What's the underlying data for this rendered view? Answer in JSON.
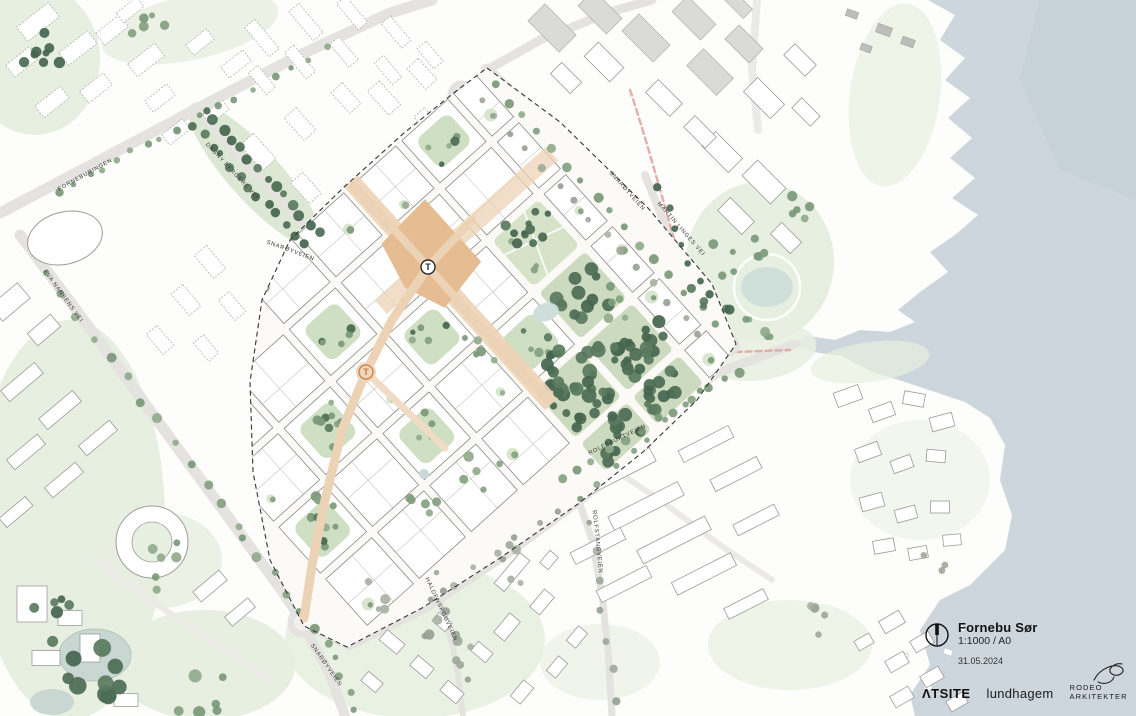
{
  "title_block": {
    "project": "Fornebu Sør",
    "scale": "1:1000 / A0",
    "date": "31.05.2024"
  },
  "logos": {
    "atsite": "ΛTSITE",
    "lundhagem": "lundhagem",
    "rodeo_line1": "RODEO",
    "rodeo_line2": "ARKITEKTER"
  },
  "street_labels": [
    {
      "text": "FORNEBURINGEN",
      "x": 86,
      "y": 176,
      "rot": -29
    },
    {
      "text": "DAGNY BERGERS VEI",
      "x": 231,
      "y": 172,
      "rot": 47
    },
    {
      "text": "EVA NANSENS VEI",
      "x": 62,
      "y": 297,
      "rot": 54
    },
    {
      "text": "SNARØYVEIEN",
      "x": 290,
      "y": 252,
      "rot": 20
    },
    {
      "text": "SNARØYVEIEN",
      "x": 626,
      "y": 192,
      "rot": 48
    },
    {
      "text": "MARTIN LINGES VEI",
      "x": 680,
      "y": 230,
      "rot": 49
    },
    {
      "text": "ROLFSBUKTVEIEN",
      "x": 618,
      "y": 441,
      "rot": -26
    },
    {
      "text": "ROLFSTANGVEIEN",
      "x": 596,
      "y": 542,
      "rot": 84
    },
    {
      "text": "HALDENSKOGVEIEN",
      "x": 440,
      "y": 610,
      "rot": 65
    },
    {
      "text": "SNARØYVEIEN",
      "x": 325,
      "y": 666,
      "rot": 55
    }
  ],
  "markers": [
    {
      "label": "T",
      "x": 428,
      "y": 267,
      "style": "dark"
    },
    {
      "label": "T",
      "x": 366,
      "y": 372,
      "style": "orange"
    }
  ],
  "colors": {
    "water": "#ccd6dc",
    "water_deep": "#c2ced6",
    "land": "#fdfdfb",
    "site_fill": "#fcfaf6",
    "park_light": "#e7efe0",
    "park_mid": "#d5e2c8",
    "forest_fill": "#ccdbbf",
    "plaza": "#e6bd93",
    "plaza_street": "#edd3b6",
    "road": "#e4e3e0",
    "building_stroke": "#8a8a88",
    "context_stroke": "#a9a9a7",
    "boundary": "#333333",
    "metro_pink": "#e0a8a2",
    "marker_orange": "#c97a3d",
    "ink": "#111111",
    "tree_dark": "#4d6d54",
    "tree_mid": "#86a383",
    "tree_gray": "#a0aa9c"
  }
}
